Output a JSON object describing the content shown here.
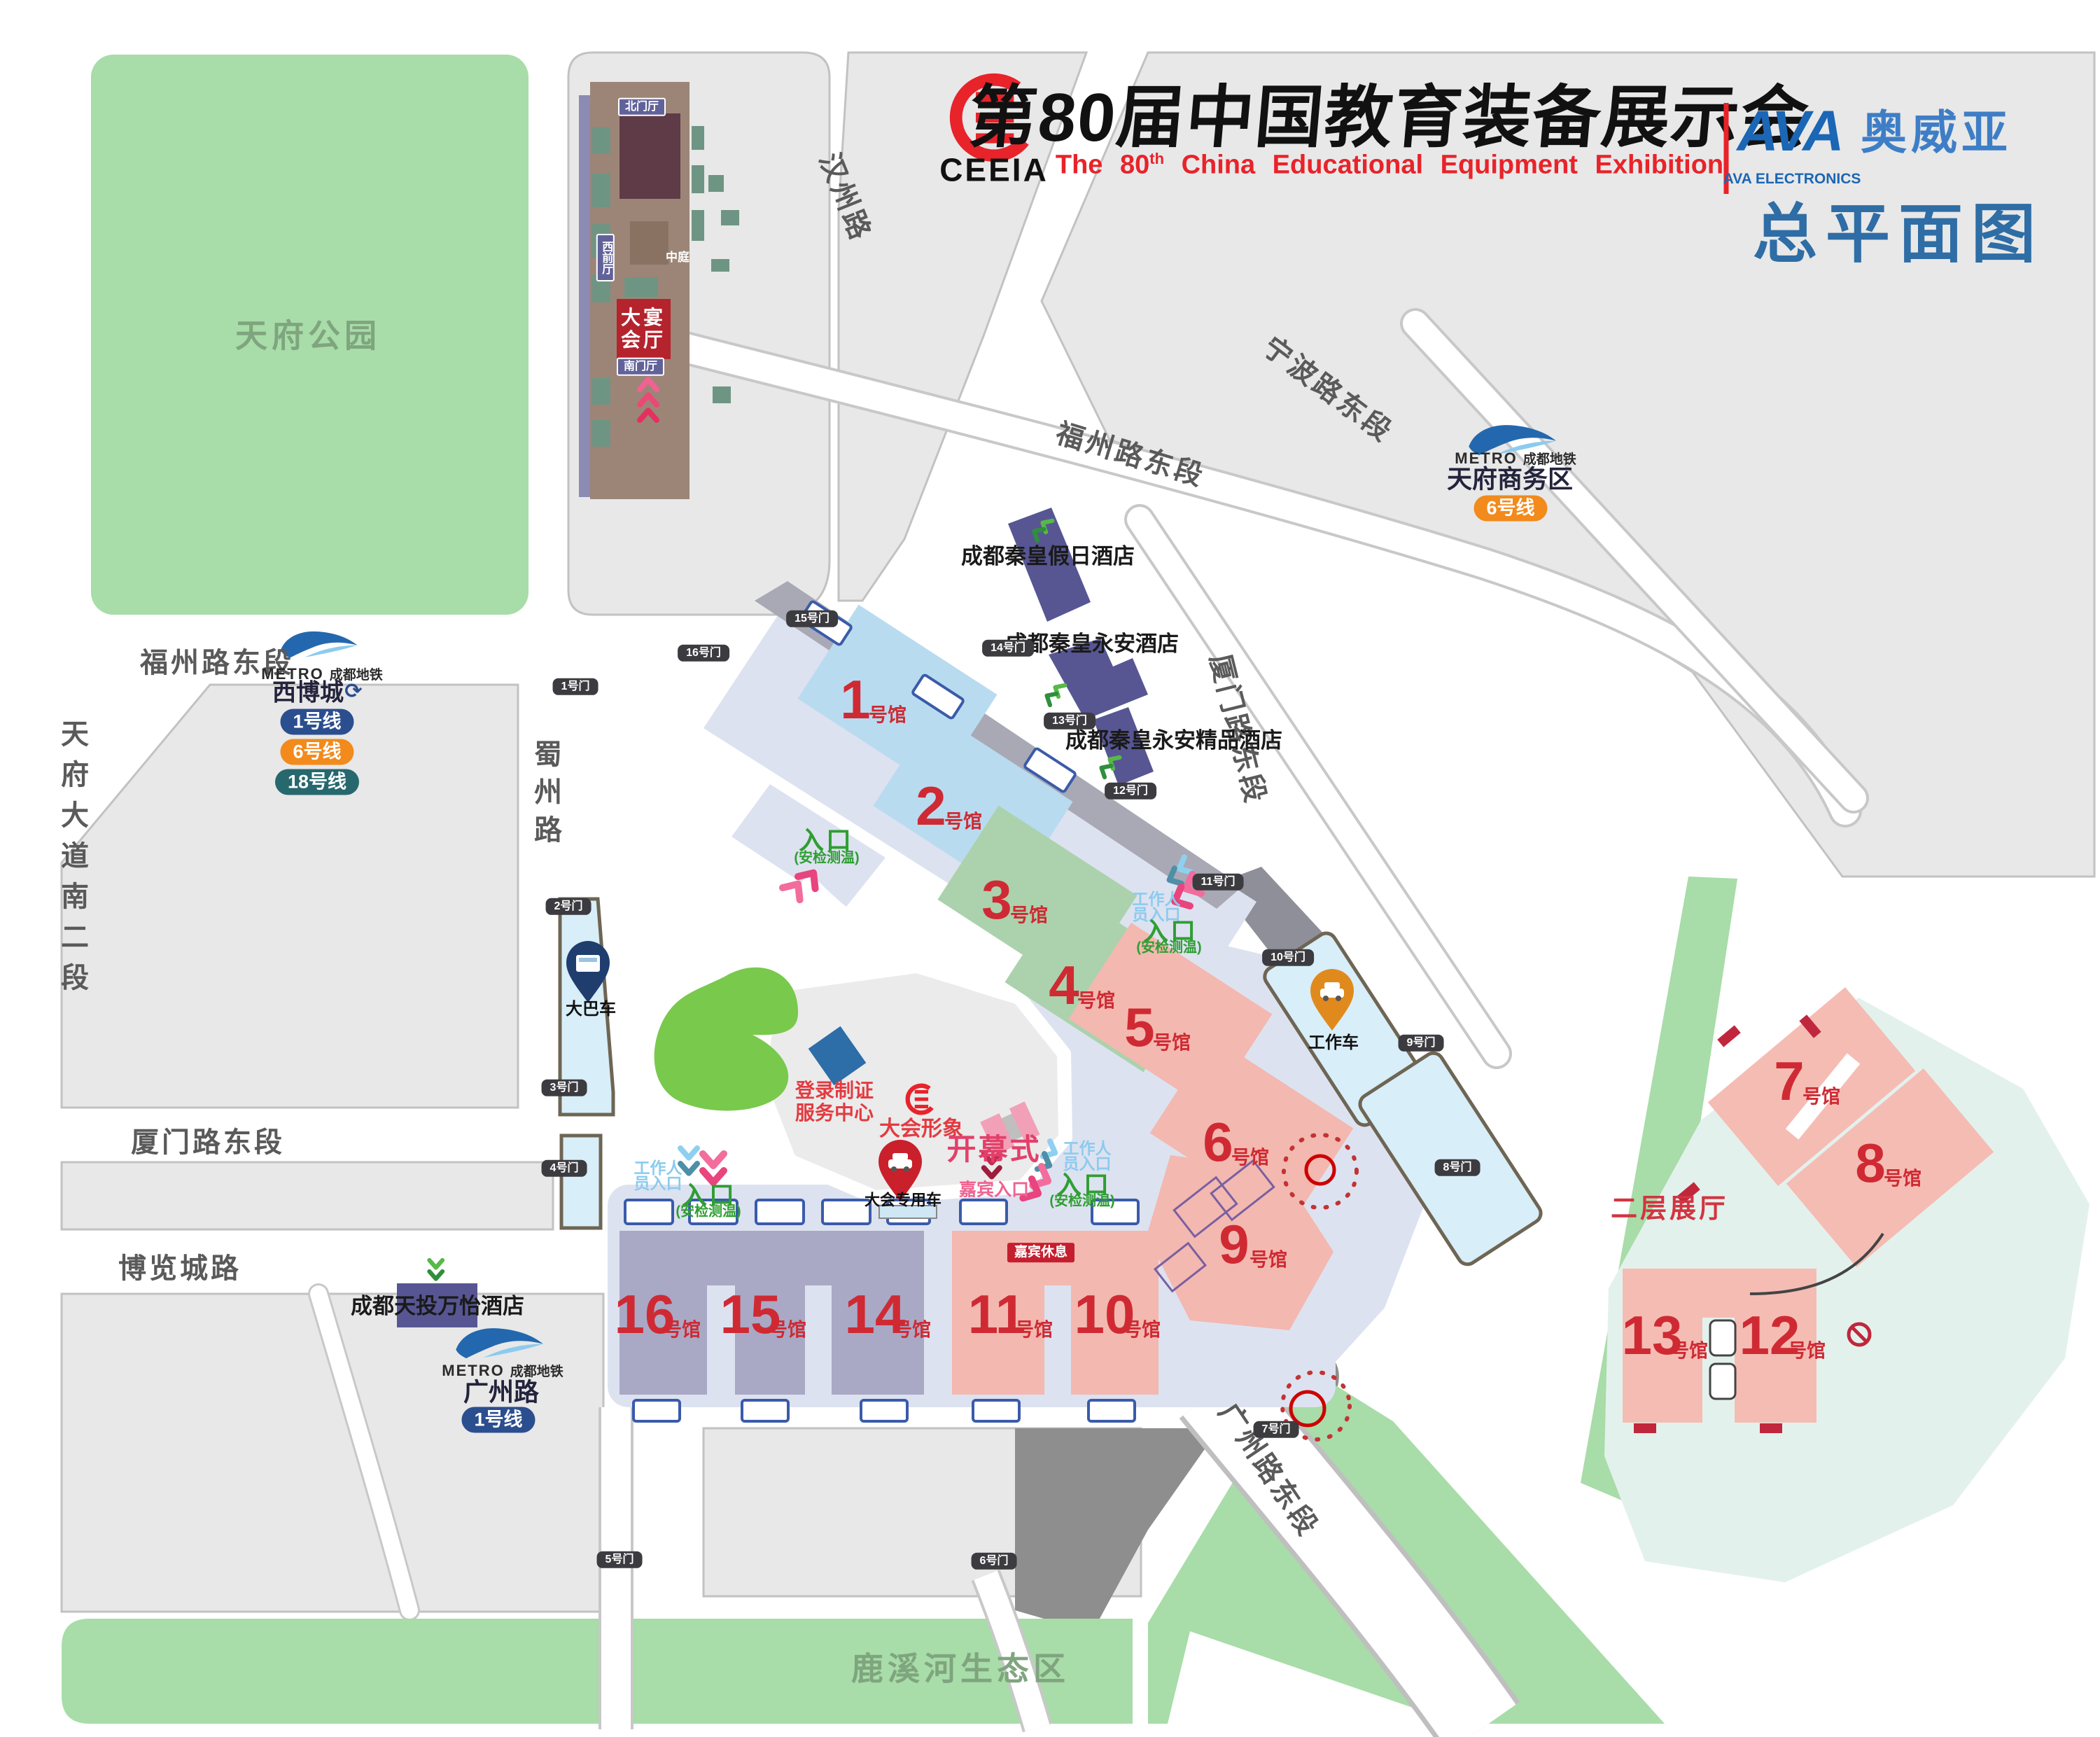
{
  "header": {
    "ceeia": "CEEIA",
    "title_cn": "第80届中国教育装备展示会",
    "title_en_prefix": "The 80",
    "title_en_sup": "th",
    "title_en_suffix": " China Educational Equipment Exhibition",
    "ava_mark": "AVA",
    "ava_en": "AVA ELECTRONICS",
    "ava_cn": "奥威亚",
    "map_title": "总平面图"
  },
  "parks": {
    "tianfu": "天府公园",
    "luxi": "鹿溪河生态区"
  },
  "roads": {
    "tianfu_avenue": "天府大道南二段",
    "fuzhou_left": "福州路东段",
    "fuzhou_top": "福州路东段",
    "hanzhou": "汉州路",
    "ningbo": "宁波路东段",
    "xiamen_right": "厦门路东段",
    "xiamen_left": "厦门路东段",
    "bolancheng": "博览城路",
    "shuzhou": "蜀州路",
    "guangzhou_east": "广州路东段"
  },
  "metro": {
    "brand_en": "METRO",
    "brand_cn": "成都地铁",
    "loop_icon": "⟳",
    "stations": [
      {
        "name": "西博城",
        "lines": [
          "1号线",
          "6号线",
          "18号线"
        ]
      },
      {
        "name": "天府商务区",
        "lines": [
          "6号线"
        ]
      },
      {
        "name": "广州路",
        "lines": [
          "1号线"
        ]
      }
    ]
  },
  "hotels": {
    "holiday": "成都秦皇假日酒店",
    "yongan": "成都秦皇永安酒店",
    "boutique": "成都秦皇永安精品酒店",
    "wanyi": "成都天投万怡酒店"
  },
  "venue_building": {
    "north": "北门厅",
    "west": "西前厅",
    "atrium": "中庭",
    "banquet": "大宴会厅",
    "south": "南门厅"
  },
  "halls": [
    {
      "num": "1",
      "suffix": "号馆"
    },
    {
      "num": "2",
      "suffix": "号馆"
    },
    {
      "num": "3",
      "suffix": "号馆"
    },
    {
      "num": "4",
      "suffix": "号馆"
    },
    {
      "num": "5",
      "suffix": "号馆"
    },
    {
      "num": "6",
      "suffix": "号馆"
    },
    {
      "num": "7",
      "suffix": "号馆"
    },
    {
      "num": "8",
      "suffix": "号馆"
    },
    {
      "num": "9",
      "suffix": "号馆"
    },
    {
      "num": "10",
      "suffix": "号馆"
    },
    {
      "num": "11",
      "suffix": "号馆"
    },
    {
      "num": "12",
      "suffix": "号馆"
    },
    {
      "num": "13",
      "suffix": "号馆"
    },
    {
      "num": "14",
      "suffix": "号馆"
    },
    {
      "num": "15",
      "suffix": "号馆"
    },
    {
      "num": "16",
      "suffix": "号馆"
    }
  ],
  "gates": [
    {
      "label": "1号门"
    },
    {
      "label": "2号门"
    },
    {
      "label": "3号门"
    },
    {
      "label": "4号门"
    },
    {
      "label": "5号门"
    },
    {
      "label": "6号门"
    },
    {
      "label": "7号门"
    },
    {
      "label": "8号门"
    },
    {
      "label": "9号门"
    },
    {
      "label": "10号门"
    },
    {
      "label": "11号门"
    },
    {
      "label": "12号门"
    },
    {
      "label": "13号门"
    },
    {
      "label": "14号门"
    },
    {
      "label": "15号门"
    },
    {
      "label": "16号门"
    }
  ],
  "entrances": {
    "entry": "入口",
    "security": "(安检测温)",
    "staff_line1": "工作人",
    "staff_line2": "员入口",
    "guest": "嘉宾入口",
    "guest_lounge": "嘉宾休息"
  },
  "facilities": {
    "bus": "大巴车",
    "work_vehicle": "工作车",
    "conference_car": "大会专用车",
    "registration_line1": "登录制证",
    "registration_line2": "服务中心",
    "brand_display": "大会形象",
    "opening": "开幕式",
    "second_floor": "二层展厅"
  },
  "colors": {
    "hall_blue": "#b9dbef",
    "hall_green": "#abd2ad",
    "hall_pink": "#f3b8b0",
    "hall_purple": "#a9a9c6",
    "hall_number_red": "#cf2a33",
    "line1": "#2b4e8f",
    "line6": "#f28a1c",
    "line18": "#26686e",
    "accent_red": "#e8232a",
    "map_title_blue": "#2e6da5",
    "ava_blue": "#1b66b5"
  }
}
